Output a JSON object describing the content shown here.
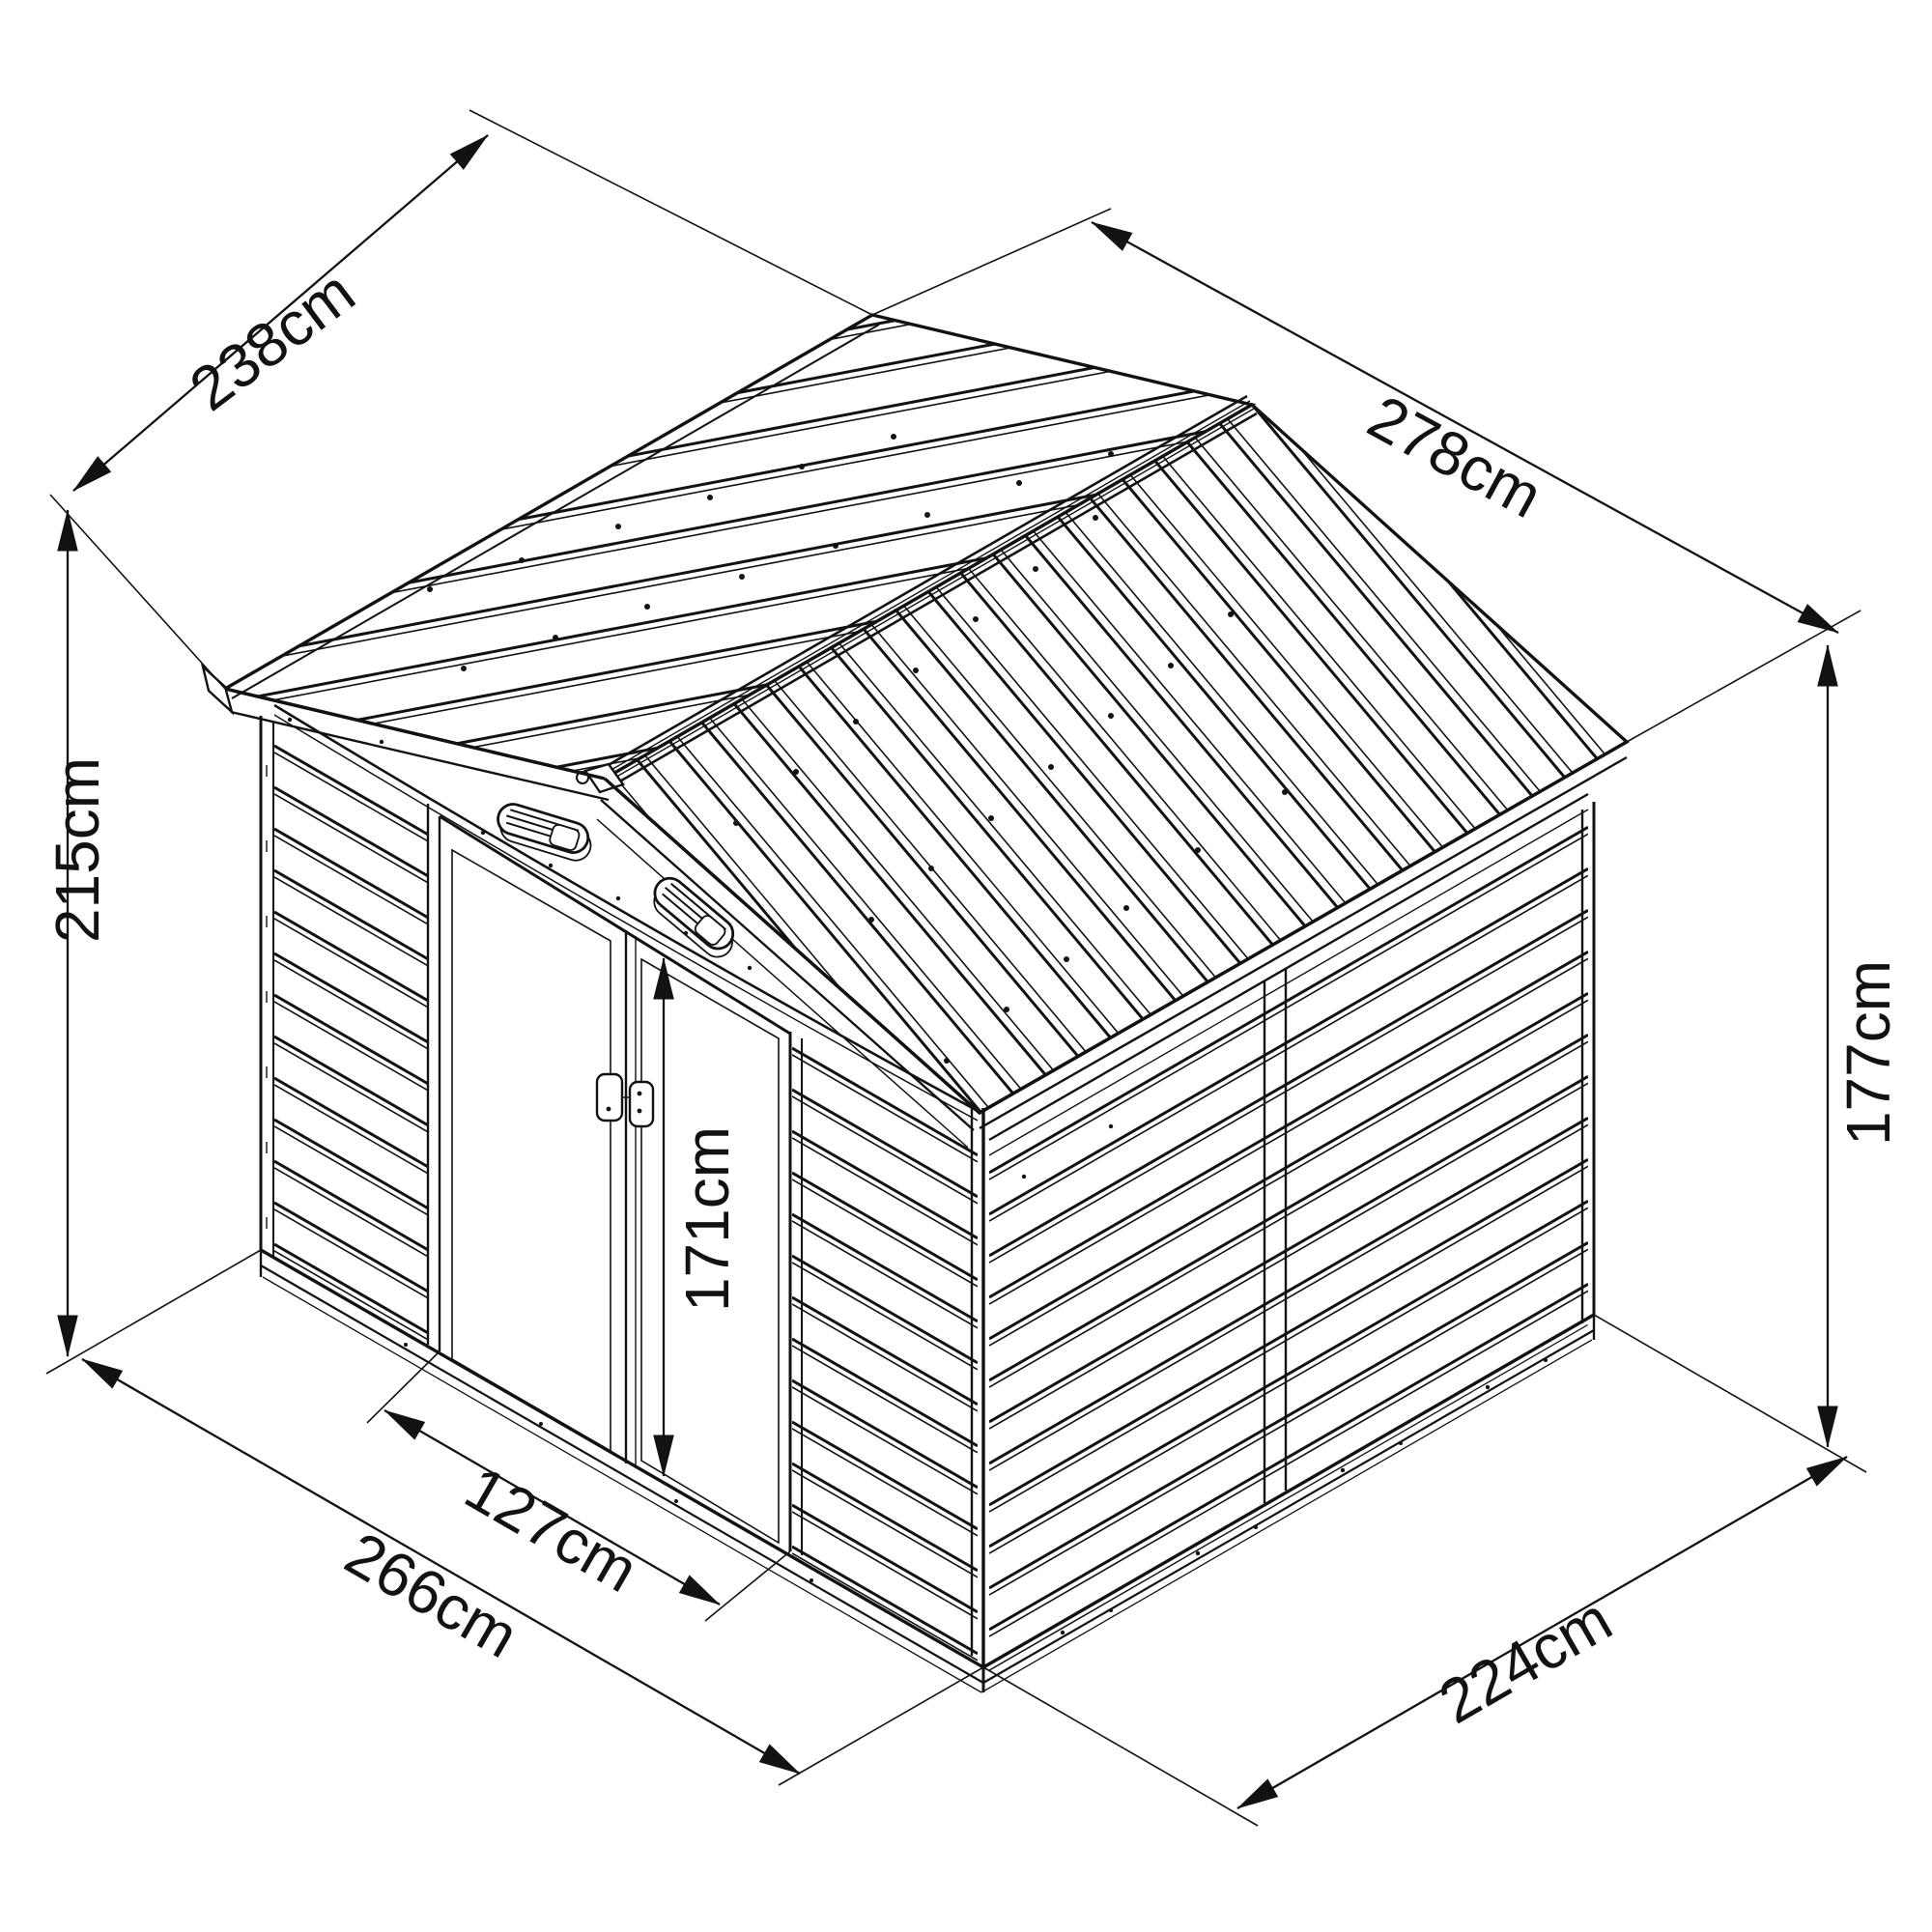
{
  "diagram": {
    "type": "isometric_dimension_drawing",
    "subject": "metal garden shed with gable roof and double sliding doors",
    "unit": "cm",
    "colors": {
      "line": "#121212",
      "background": "#ffffff"
    },
    "dimensions": {
      "roof_depth": {
        "value": 238,
        "label": "238cm",
        "measures": "roof length along left slope edge (front to back)"
      },
      "roof_width": {
        "value": 278,
        "label": "278cm",
        "measures": "roof width across gable"
      },
      "total_height": {
        "value": 215,
        "label": "215cm",
        "measures": "ground to ridge total height"
      },
      "wall_height": {
        "value": 177,
        "label": "177cm",
        "measures": "ground to eave wall height"
      },
      "door_height": {
        "value": 171,
        "label": "171cm",
        "measures": "door opening height"
      },
      "door_width": {
        "value": 127,
        "label": "127cm",
        "measures": "door opening width"
      },
      "base_width": {
        "value": 266,
        "label": "266cm",
        "measures": "front base width"
      },
      "base_depth": {
        "value": 224,
        "label": "224cm",
        "measures": "side base depth"
      }
    },
    "features": [
      "corrugated gable roof panels",
      "ridge cap",
      "two oval gable vents",
      "double sliding doors",
      "door handle with lock",
      "horizontal wall siding",
      "base rail"
    ]
  }
}
